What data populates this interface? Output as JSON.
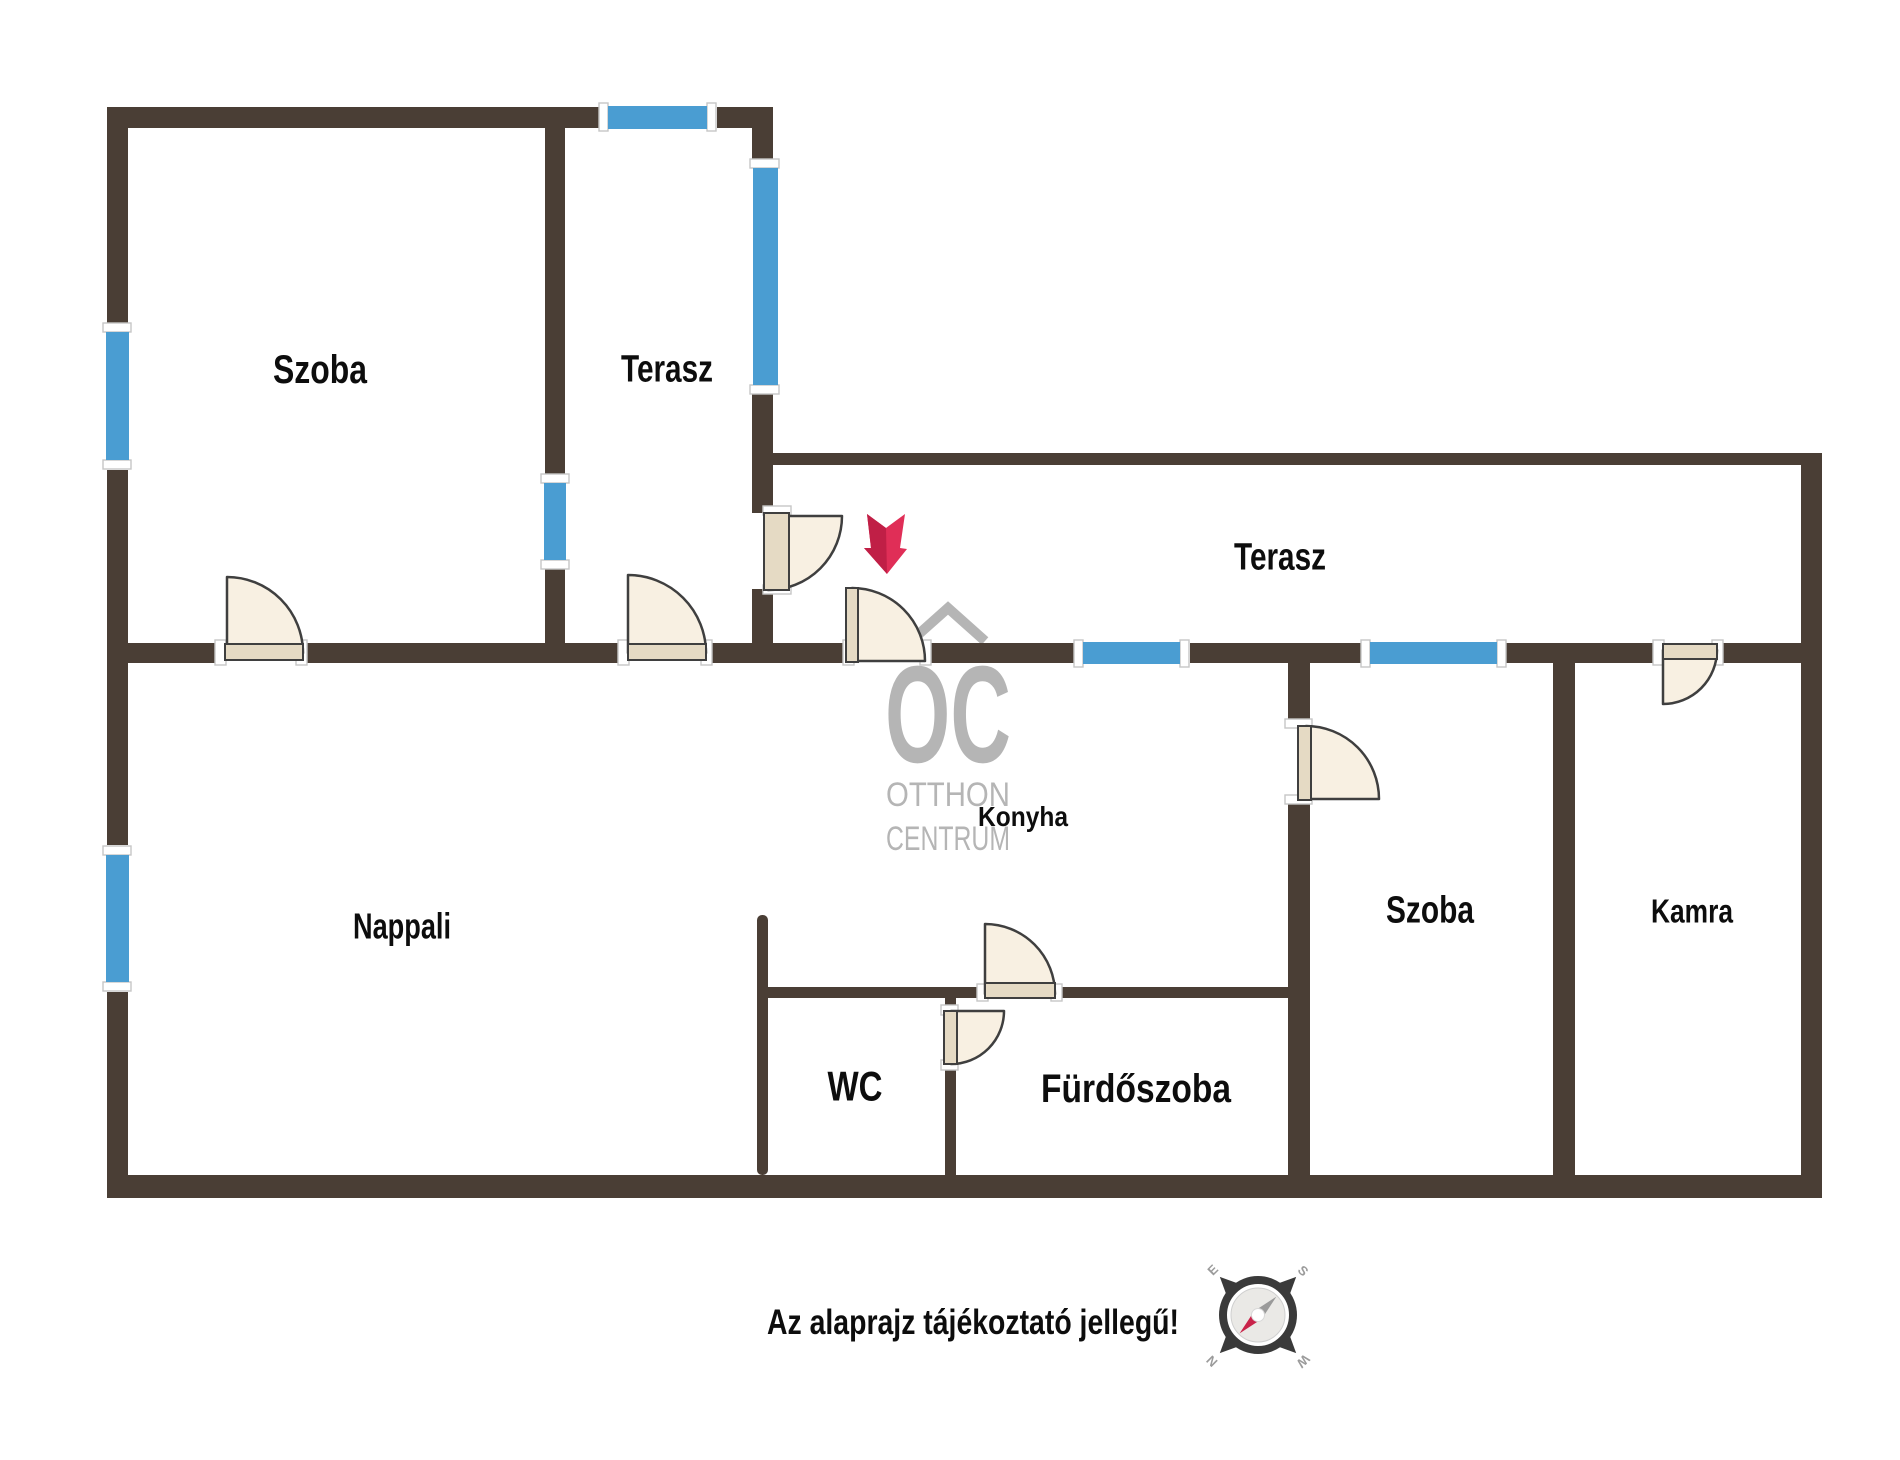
{
  "floorplan": {
    "canvas": {
      "width": 1900,
      "height": 1460,
      "background": "#ffffff"
    },
    "colors": {
      "wall": "#4a3e35",
      "window": "#4a9dd2",
      "window_cap": "#ffffff",
      "cap_stroke": "#c6c6c6",
      "door_fill": "#f8f0e2",
      "door_leaf": "#e5dac4",
      "door_stroke": "#3f3f3f",
      "arrow_main": "#e02e57",
      "arrow_shade": "#c01f46",
      "label": "#0d0d0d",
      "watermark": "#b5b5b5",
      "compass_dark": "#3a3a3a",
      "compass_face": "#eae9e6",
      "compass_text": "#9b9b9b",
      "needle_red": "#c9234a",
      "needle_gray": "#9a9a9a"
    },
    "walls": [
      {
        "id": "top-left-a",
        "r": [
          107,
          107,
          501,
          21
        ]
      },
      {
        "id": "top-left-b",
        "r": [
          717,
          107,
          56,
          21
        ]
      },
      {
        "id": "outer-left-a",
        "r": [
          107,
          107,
          21,
          220
        ]
      },
      {
        "id": "outer-left-b",
        "r": [
          107,
          470,
          21,
          173
        ]
      },
      {
        "id": "outer-left-c",
        "r": [
          107,
          663,
          21,
          182
        ]
      },
      {
        "id": "outer-left-d",
        "r": [
          107,
          992,
          21,
          183
        ]
      },
      {
        "id": "divider-szoba-terasz-a",
        "r": [
          545,
          128,
          20,
          347
        ]
      },
      {
        "id": "divider-szoba-terasz-b",
        "r": [
          545,
          568,
          20,
          75
        ]
      },
      {
        "id": "terasz-right-a",
        "r": [
          752,
          107,
          21,
          55
        ]
      },
      {
        "id": "terasz-right-b",
        "r": [
          752,
          391,
          21,
          122
        ]
      },
      {
        "id": "terasz-right-c",
        "r": [
          752,
          589,
          21,
          54
        ]
      },
      {
        "id": "big-terasz-top",
        "r": [
          773,
          453,
          1049,
          12
        ]
      },
      {
        "id": "outer-right",
        "r": [
          1801,
          453,
          21,
          745
        ]
      },
      {
        "id": "main-a",
        "r": [
          107,
          643,
          118,
          20
        ]
      },
      {
        "id": "main-b",
        "r": [
          300,
          643,
          328,
          20
        ]
      },
      {
        "id": "main-c",
        "r": [
          706,
          643,
          146,
          20
        ]
      },
      {
        "id": "main-d",
        "r": [
          925,
          643,
          149,
          20
        ]
      },
      {
        "id": "main-e",
        "r": [
          1190,
          643,
          171,
          20
        ]
      },
      {
        "id": "main-f",
        "r": [
          1506,
          643,
          316,
          20
        ]
      },
      {
        "id": "outer-bottom",
        "r": [
          107,
          1175,
          1715,
          23
        ]
      },
      {
        "id": "divider-konyha-szoba-a",
        "r": [
          1288,
          663,
          22,
          64
        ]
      },
      {
        "id": "divider-konyha-szoba-b",
        "r": [
          1288,
          800,
          22,
          375
        ]
      },
      {
        "id": "divider-szoba-kamra",
        "r": [
          1553,
          663,
          22,
          512
        ]
      },
      {
        "id": "wc-left",
        "r": [
          757,
          915,
          11,
          260
        ],
        "rx": 5
      },
      {
        "id": "wc-top-a",
        "r": [
          757,
          987,
          228,
          11
        ]
      },
      {
        "id": "wc-top-b",
        "r": [
          1057,
          987,
          231,
          11
        ]
      },
      {
        "id": "wc-right-a",
        "r": [
          945,
          998,
          11,
          14
        ]
      },
      {
        "id": "wc-right-b",
        "r": [
          945,
          1064,
          11,
          111
        ]
      }
    ],
    "windows": [
      {
        "id": "szoba-tl-window",
        "glass": [
          106,
          332,
          23,
          128
        ],
        "caps": [
          [
            103,
            323,
            28,
            9
          ],
          [
            103,
            460,
            28,
            9
          ]
        ]
      },
      {
        "id": "nappali-window",
        "glass": [
          106,
          855,
          23,
          127
        ],
        "caps": [
          [
            103,
            846,
            28,
            9
          ],
          [
            103,
            982,
            28,
            9
          ]
        ]
      },
      {
        "id": "terasz-top-window",
        "glass": [
          608,
          106,
          99,
          23
        ],
        "caps": [
          [
            599,
            103,
            9,
            28
          ],
          [
            707,
            103,
            9,
            28
          ]
        ]
      },
      {
        "id": "szoba-terasz-window",
        "glass": [
          544,
          483,
          22,
          77
        ],
        "caps": [
          [
            541,
            474,
            28,
            9
          ],
          [
            541,
            560,
            28,
            9
          ]
        ]
      },
      {
        "id": "terasz-side-window",
        "glass": [
          753,
          168,
          25,
          217
        ],
        "caps": [
          [
            750,
            159,
            29,
            9
          ],
          [
            750,
            385,
            29,
            9
          ]
        ]
      },
      {
        "id": "main-wall-window-1",
        "glass": [
          1083,
          642,
          97,
          22
        ],
        "caps": [
          [
            1074,
            640,
            9,
            27
          ],
          [
            1180,
            640,
            9,
            27
          ]
        ]
      },
      {
        "id": "main-wall-window-2",
        "glass": [
          1370,
          642,
          127,
          22
        ],
        "caps": [
          [
            1361,
            640,
            9,
            27
          ],
          [
            1497,
            640,
            9,
            27
          ]
        ]
      }
    ],
    "door_marks": [
      [
        215,
        640,
        11,
        25
      ],
      [
        296,
        640,
        11,
        25
      ],
      [
        618,
        640,
        11,
        25
      ],
      [
        701,
        640,
        11,
        25
      ],
      [
        843,
        640,
        11,
        25
      ],
      [
        920,
        640,
        11,
        25
      ],
      [
        763,
        506,
        28,
        9
      ],
      [
        763,
        585,
        28,
        9
      ],
      [
        977,
        984,
        11,
        17
      ],
      [
        1051,
        984,
        11,
        17
      ],
      [
        941,
        1005,
        17,
        10
      ],
      [
        941,
        1060,
        17,
        10
      ],
      [
        1285,
        719,
        27,
        9
      ],
      [
        1285,
        795,
        27,
        9
      ],
      [
        1653,
        640,
        11,
        25
      ],
      [
        1712,
        640,
        11,
        25
      ]
    ],
    "doors": [
      {
        "id": "szoba-tl-door",
        "pivot": [
          227,
          653
        ],
        "start": [
          227,
          577
        ],
        "end": [
          303,
          653
        ],
        "r": 76,
        "leaf": [
          225,
          644,
          78,
          16
        ]
      },
      {
        "id": "terasz-small-door",
        "pivot": [
          628,
          653
        ],
        "start": [
          628,
          575
        ],
        "end": [
          706,
          653
        ],
        "r": 78,
        "leaf": [
          628,
          644,
          78,
          16
        ]
      },
      {
        "id": "konyha-entry-door",
        "pivot": [
          852,
          661
        ],
        "start": [
          852,
          588
        ],
        "end": [
          925,
          661
        ],
        "r": 73,
        "leaf": [
          846,
          588,
          12,
          74
        ]
      },
      {
        "id": "entrance-door",
        "pivot": [
          768,
          516
        ],
        "start": [
          842,
          516
        ],
        "end": [
          768,
          590
        ],
        "r": 74,
        "leaf": [
          764,
          513,
          25,
          77
        ]
      },
      {
        "id": "furdoszoba-door",
        "pivot": [
          985,
          994
        ],
        "start": [
          985,
          924
        ],
        "end": [
          1055,
          994
        ],
        "r": 70,
        "leaf": [
          985,
          983,
          70,
          15
        ]
      },
      {
        "id": "wc-door",
        "pivot": [
          951,
          1011
        ],
        "start": [
          1004,
          1011
        ],
        "end": [
          951,
          1064
        ],
        "r": 53,
        "leaf": [
          944,
          1011,
          13,
          53
        ]
      },
      {
        "id": "szoba-right-door",
        "pivot": [
          1306,
          799
        ],
        "start": [
          1306,
          726
        ],
        "end": [
          1379,
          799
        ],
        "r": 73,
        "leaf": [
          1298,
          726,
          13,
          74
        ]
      },
      {
        "id": "kamra-door",
        "pivot": [
          1663,
          650
        ],
        "start": [
          1717,
          650
        ],
        "end": [
          1663,
          704
        ],
        "r": 54,
        "leaf": [
          1663,
          644,
          54,
          15
        ]
      }
    ],
    "rooms": [
      {
        "id": "szoba-top-left",
        "label": "Szoba",
        "x": 320,
        "y": 369,
        "size": 40,
        "w": 94
      },
      {
        "id": "terasz-small",
        "label": "Terasz",
        "x": 667,
        "y": 368,
        "size": 38,
        "w": 92
      },
      {
        "id": "terasz-big",
        "label": "Terasz",
        "x": 1280,
        "y": 556,
        "size": 38,
        "w": 92
      },
      {
        "id": "nappali",
        "label": "Nappali",
        "x": 402,
        "y": 926,
        "size": 36,
        "w": 98
      },
      {
        "id": "konyha",
        "label": "Konyha",
        "x": 1023,
        "y": 816,
        "size": 28,
        "w": 90
      },
      {
        "id": "wc",
        "label": "WC",
        "x": 855,
        "y": 1086,
        "size": 42,
        "w": 55
      },
      {
        "id": "furdoszoba",
        "label": "Fürdőszoba",
        "x": 1136,
        "y": 1088,
        "size": 40,
        "w": 190
      },
      {
        "id": "szoba-right",
        "label": "Szoba",
        "x": 1430,
        "y": 909,
        "size": 38,
        "w": 88
      },
      {
        "id": "kamra",
        "label": "Kamra",
        "x": 1692,
        "y": 911,
        "size": 33,
        "w": 82
      }
    ],
    "entrance_arrow": {
      "points": "867,514 886,528 905,514 900,548 907,549 887,574 864,548 871,548",
      "shade_points": "867,514 886,528 887,574 864,548 871,548"
    },
    "watermark": {
      "house_points": "911,641 948,608 985,641",
      "lines": [
        {
          "text": "OC",
          "x": 948,
          "y": 762,
          "size": 138,
          "length": 126,
          "weight": "bold"
        },
        {
          "text": "OTTHON",
          "x": 948,
          "y": 806,
          "size": 34,
          "length": 124,
          "weight": "normal"
        },
        {
          "text": "CENTRUM",
          "x": 948,
          "y": 850,
          "size": 34,
          "length": 124,
          "weight": "normal"
        }
      ]
    },
    "compass": {
      "cx": 1258,
      "cy": 1315,
      "spike_angles": [
        45,
        135,
        225,
        315
      ],
      "spike_points": "0,-54 -13,-26 13,-26",
      "ring_r": 35,
      "face_r": 27,
      "hub_r": 6.5,
      "needle_rot": -45,
      "needle_gray_points": "26,0 2,-5 2,5",
      "needle_red_points": "-26,0 -2,-5 -2,5",
      "letters": [
        {
          "t": "E",
          "x": 1216,
          "y": 1273,
          "rot": -45
        },
        {
          "t": "S",
          "x": 1300,
          "y": 1274,
          "rot": 45
        },
        {
          "t": "N",
          "x": 1215,
          "y": 1358,
          "rot": -135
        },
        {
          "t": "W",
          "x": 1300,
          "y": 1358,
          "rot": 135
        }
      ],
      "letter_size": 13
    },
    "disclaimer": {
      "text": "Az alaprajz tájékoztató jellegű!",
      "x": 973,
      "y": 1334,
      "size": 35,
      "length": 412
    }
  }
}
